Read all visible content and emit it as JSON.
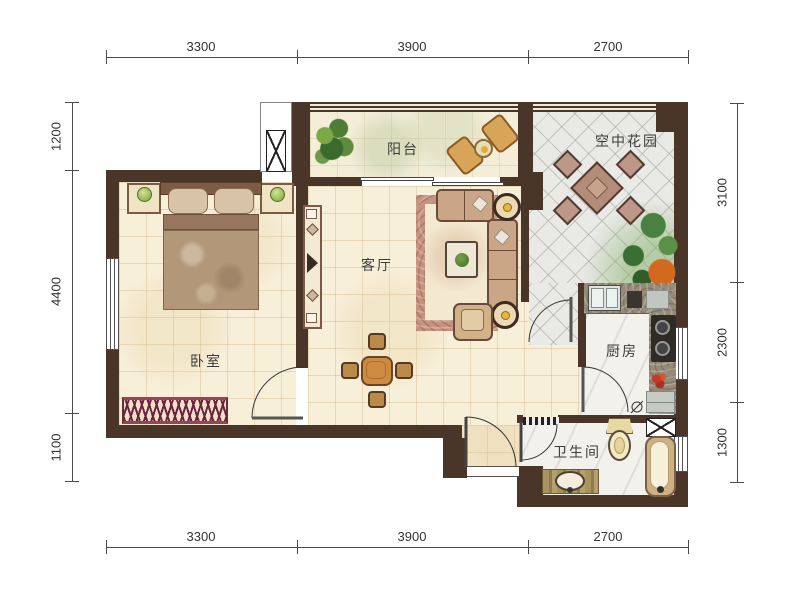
{
  "title": "apartment-floor-plan",
  "rooms": {
    "balcony": "阳台",
    "garden": "空中花园",
    "living": "客厅",
    "bedroom": "卧室",
    "kitchen": "厨房",
    "bathroom": "卫生间"
  },
  "dimensions": {
    "top": [
      "3300",
      "3900",
      "2700"
    ],
    "bottom": [
      "3300",
      "3900",
      "2700"
    ],
    "left": [
      "1200",
      "4400",
      "1100"
    ],
    "right": [
      "3100",
      "2300",
      "1300"
    ]
  },
  "colors": {
    "wall": "#4a3529",
    "floor": "#f7efd8",
    "tile": "#e9e9e6",
    "dimension_text": "#333333",
    "label_text": "#3c3c3c"
  }
}
